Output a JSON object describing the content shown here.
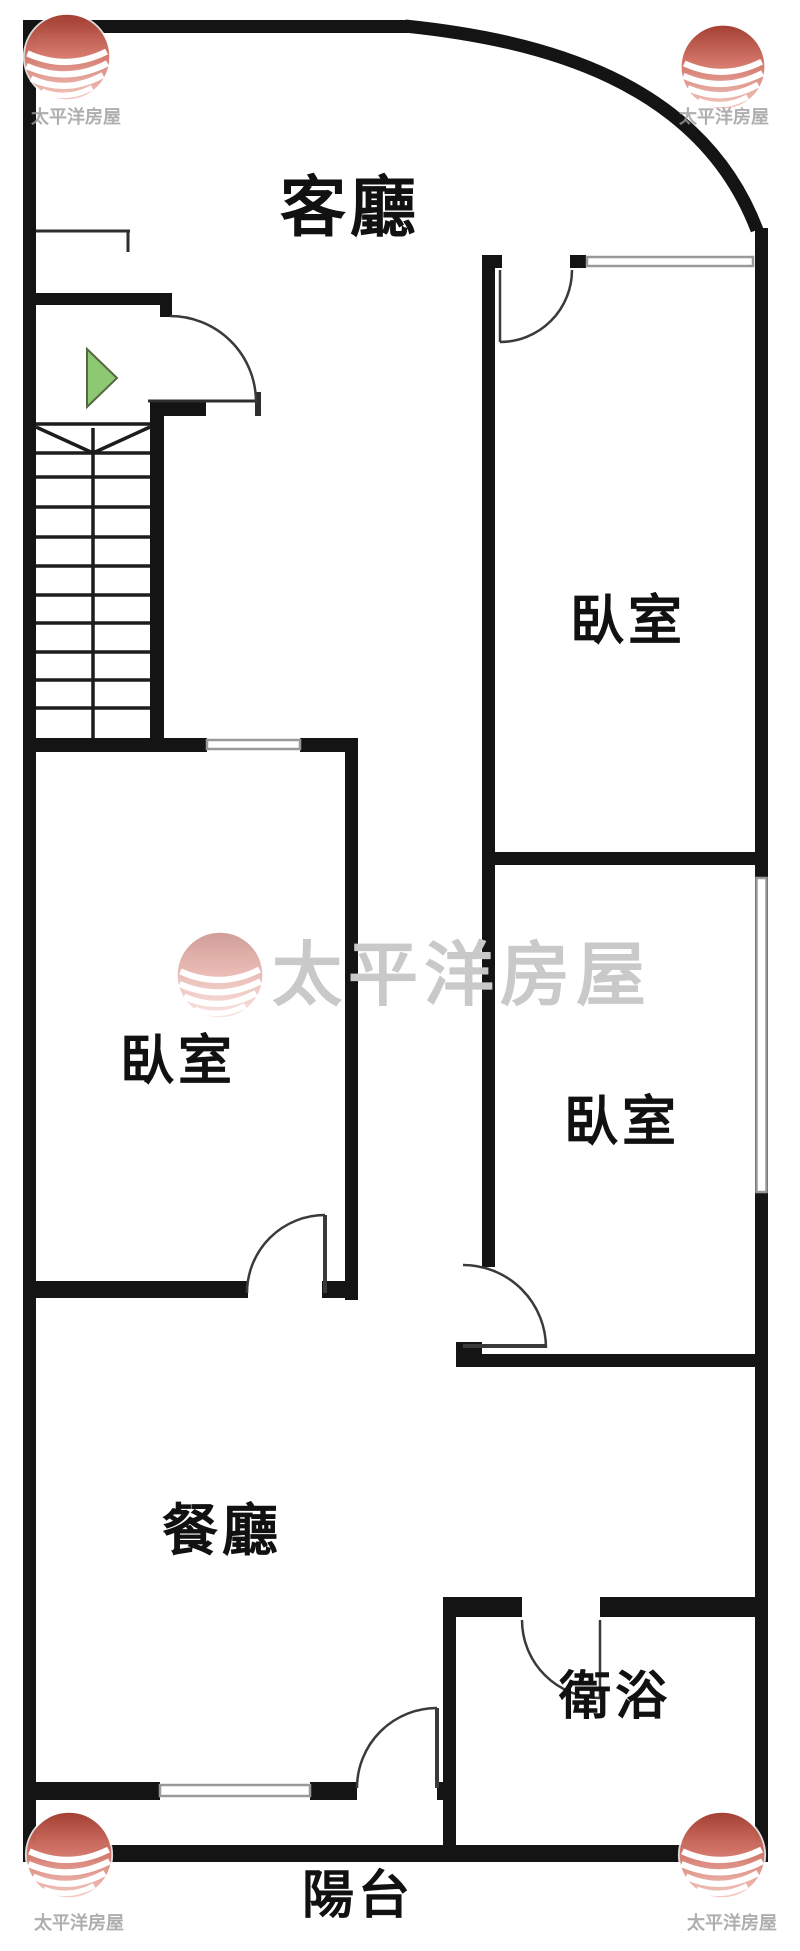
{
  "branding": {
    "name": "太平洋房屋",
    "logo_icon": "pacific-house-sphere-logo"
  },
  "rooms": {
    "living": {
      "label": "客廳"
    },
    "bedroom_right_top": {
      "label": "臥室"
    },
    "bedroom_left": {
      "label": "臥室"
    },
    "bedroom_right_bot": {
      "label": "臥室"
    },
    "dining": {
      "label": "餐廳"
    },
    "bath": {
      "label": "衛浴"
    },
    "balcony": {
      "label": "陽台"
    }
  },
  "icons": {
    "entrance_arrow": "entrance-direction-arrow"
  },
  "colors": {
    "wall": "#141414",
    "thin_line": "#2e2e2e",
    "door_arc": "#3a3a3a",
    "window_frame": "#999999",
    "arrow_green_fill": "#8dc972",
    "arrow_green_border": "#55683f",
    "logo_red_top": "#9c2f22",
    "logo_pink_bottom": "#eeb4ab",
    "watermark_text_gray": "#c9c9c9",
    "corner_text_gray": "#9b9b9b",
    "label_black": "#111111"
  }
}
